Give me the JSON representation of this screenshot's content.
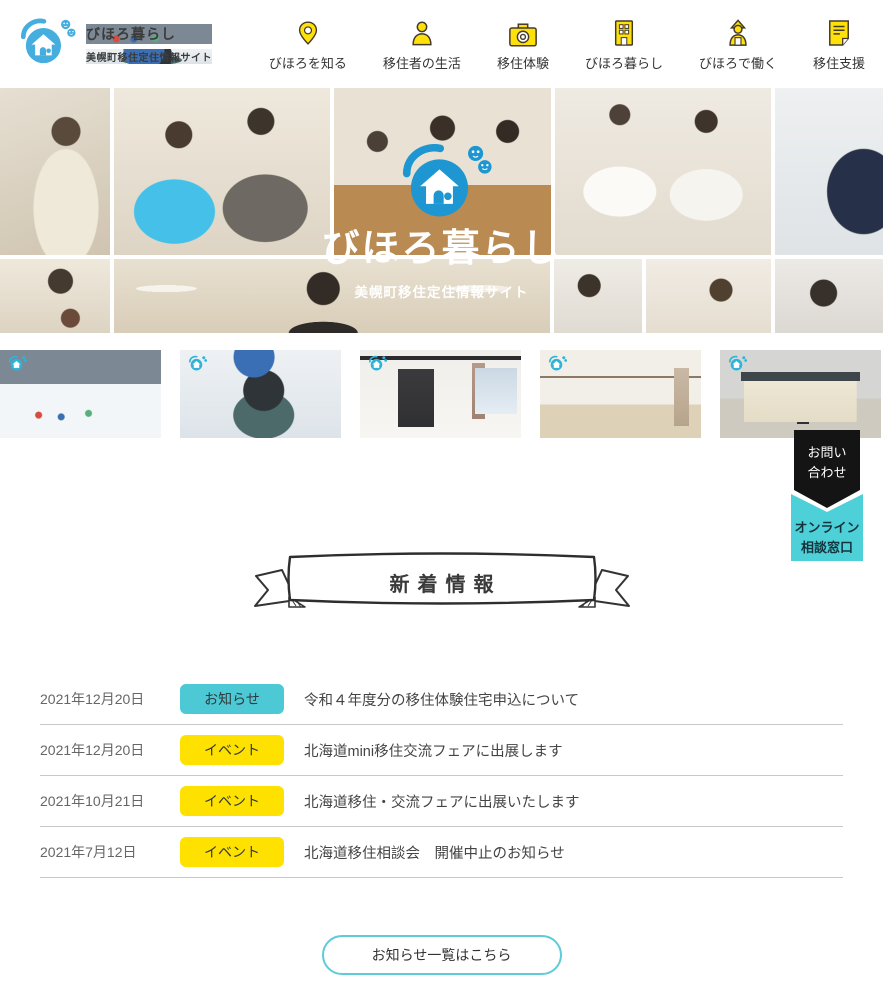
{
  "brand": {
    "title": "びほろ暮らし",
    "subtitle": "美幌町移住定住情報サイト"
  },
  "nav": {
    "items": [
      {
        "label": "びほろを知る",
        "icon": "map-pin-icon"
      },
      {
        "label": "移住者の生活",
        "icon": "person-icon"
      },
      {
        "label": "移住体験",
        "icon": "camera-icon"
      },
      {
        "label": "びほろ暮らし",
        "icon": "building-icon"
      },
      {
        "label": "びほろで働く",
        "icon": "worker-icon"
      },
      {
        "label": "移住支援",
        "icon": "document-icon"
      }
    ]
  },
  "hero": {
    "title": "びほろ暮らし",
    "subtitle": "美幌町移住定住情報サイト"
  },
  "contact": {
    "inquiry_lines": [
      "お問い",
      "合わせ"
    ],
    "online_lines": [
      "オンライン",
      "相談窓口"
    ]
  },
  "news": {
    "heading": "新着情報",
    "items": [
      {
        "date": "2021年12月20日",
        "badge": "お知らせ",
        "badge_color": "#4cc9d5",
        "text": "令和４年度分の移住体験住宅申込について"
      },
      {
        "date": "2021年12月20日",
        "badge": "イベント",
        "badge_color": "#ffe100",
        "text": "北海道mini移住交流フェアに出展します"
      },
      {
        "date": "2021年10月21日",
        "badge": "イベント",
        "badge_color": "#ffe100",
        "text": "北海道移住・交流フェアに出展いたします"
      },
      {
        "date": "2021年7月12日",
        "badge": "イベント",
        "badge_color": "#ffe100",
        "text": "北海道移住相談会　開催中止のお知らせ"
      }
    ],
    "more_label": "お知らせ一覧はこちら"
  },
  "colors": {
    "brand_blue": "#45aede",
    "hero_logo_blue": "#1e96d2",
    "nav_yellow": "#ffe10a",
    "badge_cyan": "#4cc9d5",
    "badge_yellow": "#ffe100",
    "tag_black": "#141414",
    "tag_cyan": "#4ed0d8",
    "button_border": "#5ecbd8"
  }
}
